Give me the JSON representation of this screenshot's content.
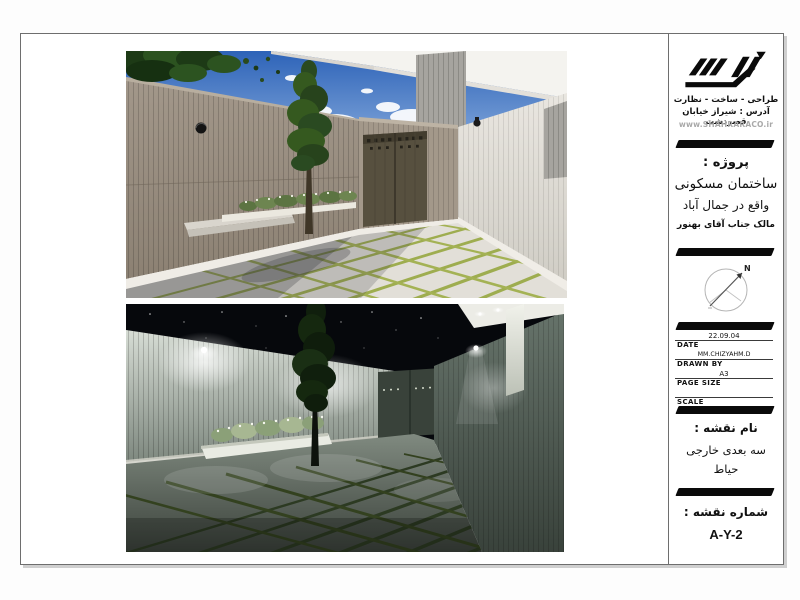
{
  "colors": {
    "paper": "#ffffff",
    "sheet_border": "#6e6e6e",
    "divider_bar": "#0a0a0a",
    "day_sky": "#3a6fc4",
    "day_wall_tan": "#9a8e80",
    "grass_joint_day": "#9ead4f",
    "grass_joint_night": "#2f3d23",
    "night_sky": "#06080c"
  },
  "titleblock": {
    "brand": {
      "tagline": "طراحی - ساخت - نظارت",
      "address": "آدرس : شیراز خیابان قصردشت",
      "website": "www.SHAHRARACO.ir"
    },
    "project": {
      "label": "پروژه :",
      "building": "ساختمان مسکونی",
      "location": "واقع در جمال آباد",
      "owner": "مالک جناب آقای بهنور"
    },
    "compass": {
      "north": "N"
    },
    "meta": {
      "date_value": "22.09.04",
      "date_label": "DATE",
      "drawn_by_value": "MM.CHIZYAHM.D",
      "drawn_by_label": "DRAWN BY",
      "page_size_value": "A3",
      "page_size_label": "PAGE SIZE",
      "scale_value": "",
      "scale_label": "SCALE"
    },
    "sheet_name": {
      "label": "نام نقشه :",
      "line1": "سه بعدی خارجی",
      "line2": "حیاط"
    },
    "sheet_number": {
      "label": "شماره نقشه :",
      "value": "A-Y-2"
    }
  }
}
